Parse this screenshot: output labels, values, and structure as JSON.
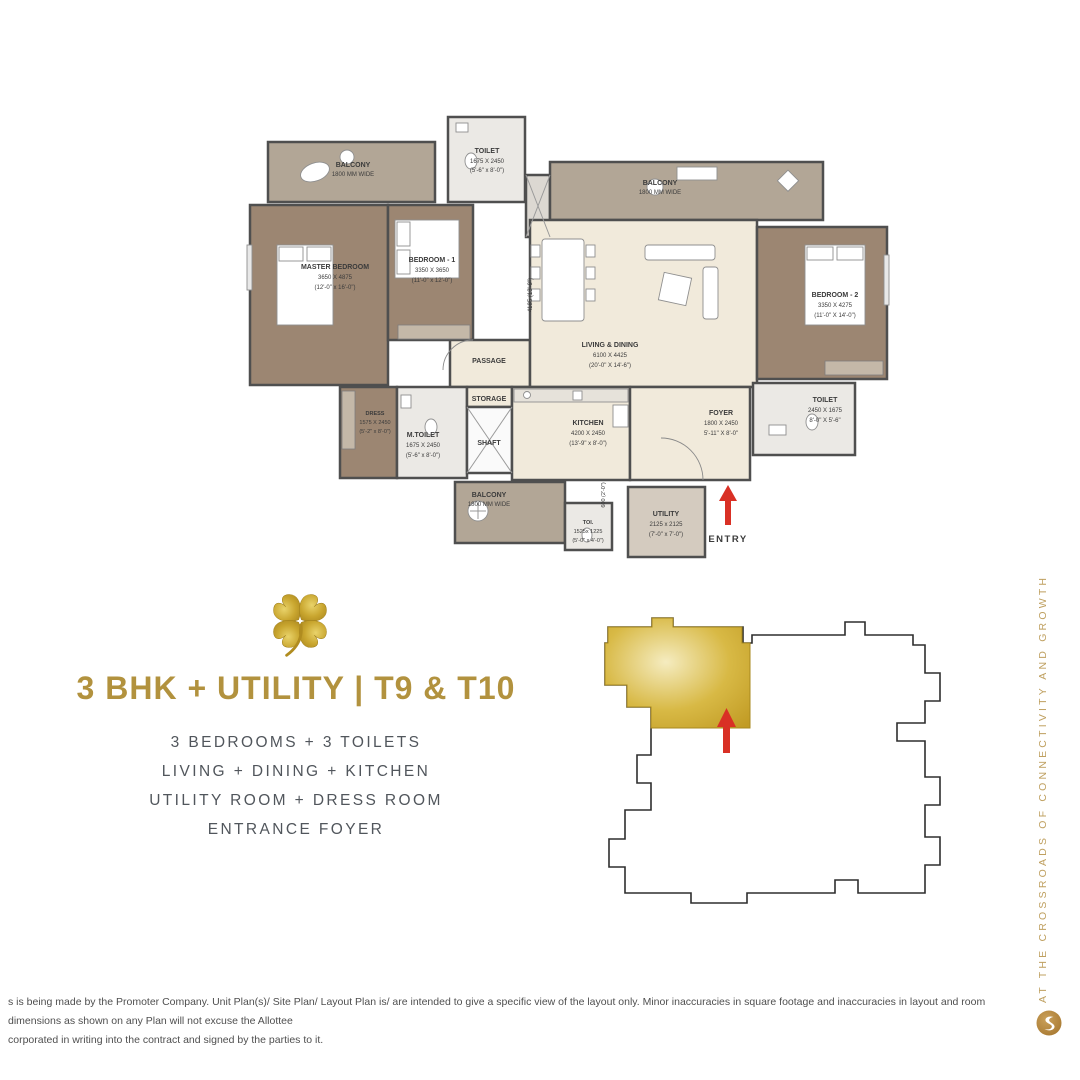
{
  "title": "3 BHK + UTILITY | T9 & T10",
  "features": [
    "3 BEDROOMS + 3 TOILETS",
    "LIVING + DINING + KITCHEN",
    "UTILITY ROOM + DRESS ROOM",
    "ENTRANCE FOYER"
  ],
  "side_text": "AT THE CROSSROADS OF CONNECTIVITY AND GROWTH",
  "disclaimer": {
    "line1": "s is being made by the Promoter Company. Unit Plan(s)/ Site Plan/ Layout Plan is/ are intended to give a specific view of the layout only. Minor inaccuracies in square footage and inaccuracies in layout and room dimensions as shown on any Plan will not excuse the Allottee",
    "line2": "corporated in writing into the contract and signed by the parties to it."
  },
  "floor_plan": {
    "rooms": {
      "balcony_left": {
        "name": "BALCONY",
        "l1": "1800 MM WIDE"
      },
      "toilet_top": {
        "name": "TOILET",
        "l1": "1675 X 2450",
        "l2": "(5'-6\" x 8'-0\")"
      },
      "balcony_right": {
        "name": "BALCONY",
        "l1": "1800 MM WIDE"
      },
      "master_bedroom": {
        "name": "MASTER BEDROOM",
        "l1": "3650 X 4875",
        "l2": "(12'-0\" x 16'-0\")"
      },
      "bedroom_1": {
        "name": "BEDROOM - 1",
        "l1": "3350 X 3650",
        "l2": "(11'-0\" x 12'-0\")"
      },
      "living_dining": {
        "name": "LIVING & DINING",
        "l1": "6100 X 4425",
        "l2": "(20'-0\" X 14'-6\")"
      },
      "bedroom_2": {
        "name": "BEDROOM - 2",
        "l1": "3350 X 4275",
        "l2": "(11'-0\" X 14'-0\")"
      },
      "toilet_right": {
        "name": "TOILET",
        "l1": "2450 X 1675",
        "l2": "8'-0\" X 5'-6\""
      },
      "passage": {
        "name": "PASSAGE"
      },
      "dress": {
        "name": "DRESS",
        "l1": "1575 X 2450",
        "l2": "(5'-2\" x 8'-0\")"
      },
      "m_toilet": {
        "name": "M.TOILET",
        "l1": "1675 X 2450",
        "l2": "(5'-6\" x 8'-0\")"
      },
      "storage": {
        "name": "STORAGE"
      },
      "shaft": {
        "name": "SHAFT"
      },
      "kitchen": {
        "name": "KITCHEN",
        "l1": "4200 X 2450",
        "l2": "(13'-9\" x 8'-0\")"
      },
      "foyer": {
        "name": "FOYER",
        "l1": "1800 X 2450",
        "l2": "5'-11\" X 8'-0\""
      },
      "balcony_bottom": {
        "name": "BALCONY",
        "l1": "1800 MM WIDE"
      },
      "toi": {
        "name": "TOI.",
        "l1": "1525x 1225",
        "l2": "(5'-0\" x 4'-0\")"
      },
      "utility": {
        "name": "UTILITY",
        "l1": "2125 x 2125",
        "l2": "(7'-0\" x 7'-0\")"
      }
    },
    "entry_label": "ENTRY",
    "dims": {
      "vertical": "4185 (13'-9\")",
      "balcony_depth": "600 (2'-0\")"
    }
  },
  "colors": {
    "gold_title": "#b2923e",
    "gold_keyplan": "#c8a42c",
    "red_arrow": "#d93025",
    "floor_cream": "#f1eadb",
    "floor_wood": "#9c8672",
    "floor_balcony": "#b2a696"
  }
}
